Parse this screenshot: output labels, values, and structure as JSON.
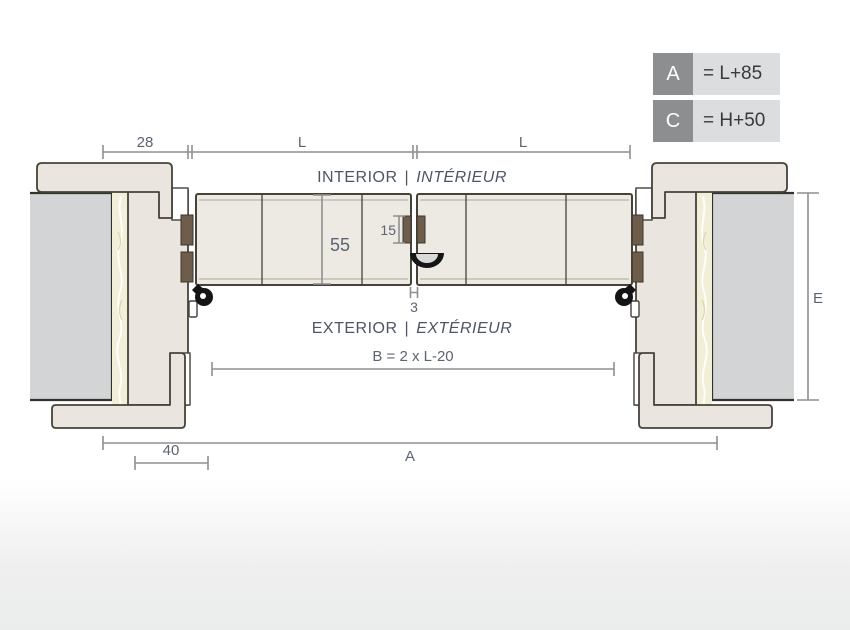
{
  "legend": {
    "rows": [
      {
        "key": "A",
        "value": "= L+85"
      },
      {
        "key": "C",
        "value": "= H+50"
      }
    ]
  },
  "zones": {
    "interior_en": "INTERIOR",
    "separator": "|",
    "interior_fr": "INTÉRIEUR",
    "exterior_en": "EXTERIOR",
    "exterior_fr": "EXTÉRIEUR"
  },
  "dimensions": {
    "frame_face": "28",
    "leaf_width_left": "L",
    "leaf_width_right": "L",
    "leaf_thickness": "55",
    "gasket_height": "15",
    "meeting_gap": "3",
    "clear_opening": "B = 2 x L-20",
    "overall_width": "A",
    "casing_offset": "40",
    "height_ref": "E"
  },
  "colors": {
    "frame_fill": "#eae6df",
    "leaf_fill": "#edeae3",
    "wall_fill": "#d3d4d6",
    "insulation_fill": "#f1efd7",
    "gasket_fill": "#6f5d4b",
    "seal_fill": "#151515",
    "outline": "#45423a",
    "dimension_line": "#8f8f8f",
    "dimension_text": "#5b6472",
    "legend_key_bg": "#8d8e90",
    "legend_value_bg": "#dcdddf"
  }
}
